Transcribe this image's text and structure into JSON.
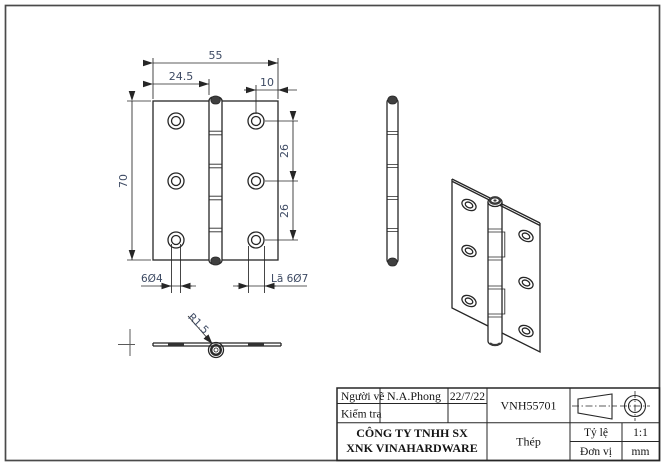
{
  "dims": {
    "total_width": "55",
    "pin_offset": "24.5",
    "hole_edge": "10",
    "total_height": "70",
    "hole_pitch_1": "26",
    "hole_pitch_2": "26",
    "holes_small": "6Ø4",
    "holes_countersunk": "Lã 6Ø7",
    "knuckle_radius": "R1.5"
  },
  "title_block": {
    "drawer_label": "Người vẽ",
    "drawer_name": "N.A.Phong",
    "date": "22/7/22",
    "checker_label": "Kiểm tra",
    "drawing_code": "VNH55701",
    "company_line1": "CÔNG TY TNHH SX",
    "company_line2": "XNK VINAHARDWARE",
    "material": "Thép",
    "scale_label": "Tỷ lệ",
    "scale_value": "1:1",
    "unit_label": "Đơn vị",
    "unit_value": "mm"
  },
  "colors": {
    "line": "#262626",
    "dim_text": "#3d4a63",
    "sheet_border": "#4a4a4a",
    "cap_fill": "#3f3f3f",
    "background": "#ffffff"
  }
}
